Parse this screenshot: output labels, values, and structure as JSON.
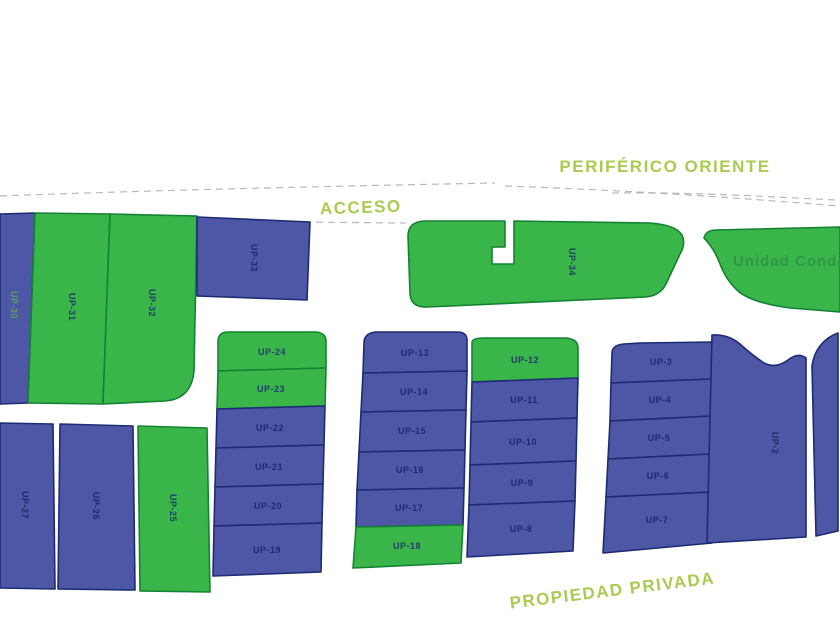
{
  "map": {
    "title": "site-subdivision-plan",
    "road_labels": {
      "periferico": "PERIFÉRICO ORIENTE",
      "acceso": "ACCESO",
      "propiedad": "PROPIEDAD PRIVADA"
    },
    "condo_label": "Unidad Condo",
    "colors": {
      "background": "#FFFFFF",
      "plot_green_fill": "#3AB54A",
      "plot_green_stroke": "#148233",
      "plot_blue_fill": "#4E57A6",
      "plot_blue_stroke": "#1C2B74",
      "plot_label_text": "#1C2B6E",
      "road_text_green": "#A9CB4F",
      "condo_text_green": "#2E9447",
      "up30_label_green": "#57A257",
      "dashed_road_edge": "#A9ADB3"
    },
    "plot_labels": {
      "up2": "UP-2",
      "up3": "UP-3",
      "up4": "UP-4",
      "up5": "UP-5",
      "up6": "UP-6",
      "up7": "UP-7",
      "up8": "UP-8",
      "up9": "UP-9",
      "up10": "UP-10",
      "up11": "UP-11",
      "up12": "UP-12",
      "up13": "UP-13",
      "up14": "UP-14",
      "up15": "UP-15",
      "up16": "UP-16",
      "up17": "UP-17",
      "up18": "UP-18",
      "up19": "UP-19",
      "up20": "UP-20",
      "up21": "UP-21",
      "up22": "UP-22",
      "up23": "UP-23",
      "up24": "UP-24",
      "up25": "UP-25",
      "up26": "UP-26",
      "up27": "UP-27",
      "up30": "UP-30",
      "up31": "UP-31",
      "up32": "UP-32",
      "up33": "UP-33",
      "up34": "UP-34"
    }
  }
}
